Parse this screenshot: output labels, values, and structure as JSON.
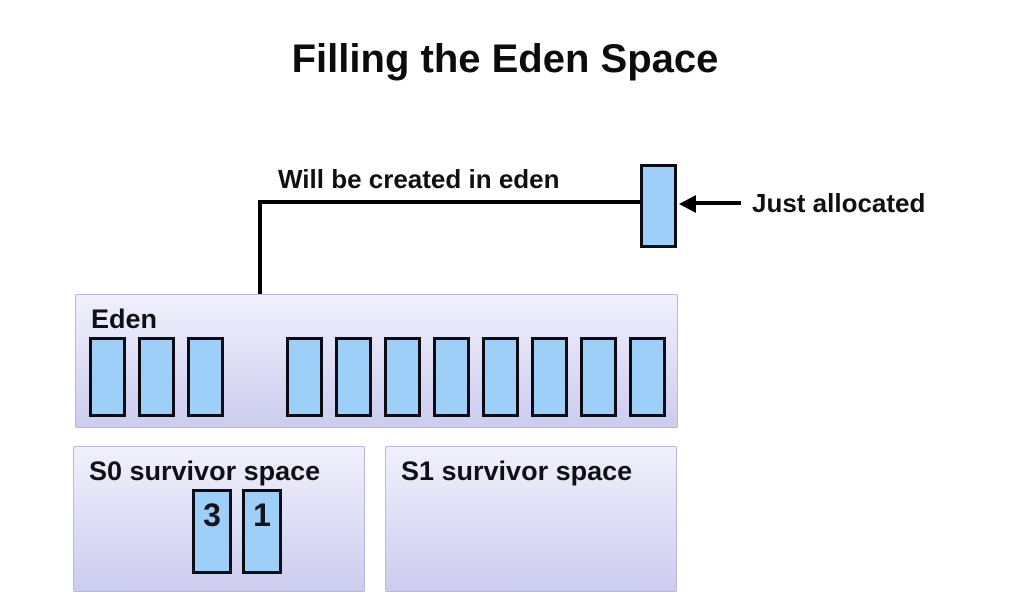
{
  "slide": {
    "title": "Filling the Eden Space"
  },
  "annotations": {
    "created_label": "Will be created in eden",
    "allocated_label": "Just allocated"
  },
  "colors": {
    "object_fill": "#9ecff8",
    "object_border": "#0b0b14",
    "panel_top": "#f1f0fc",
    "panel_bottom": "#cdccef",
    "panel_border": "#b9b8e2",
    "connector": "#000000",
    "label_text": "#101014"
  },
  "eden": {
    "label": "Eden",
    "left_objects": [
      "",
      "",
      ""
    ],
    "right_objects": [
      "",
      "",
      "",
      "",
      "",
      "",
      "",
      ""
    ]
  },
  "survivor_s0": {
    "label": "S0 survivor space",
    "objects": [
      "3",
      "1"
    ]
  },
  "survivor_s1": {
    "label": "S1 survivor space",
    "objects": []
  }
}
